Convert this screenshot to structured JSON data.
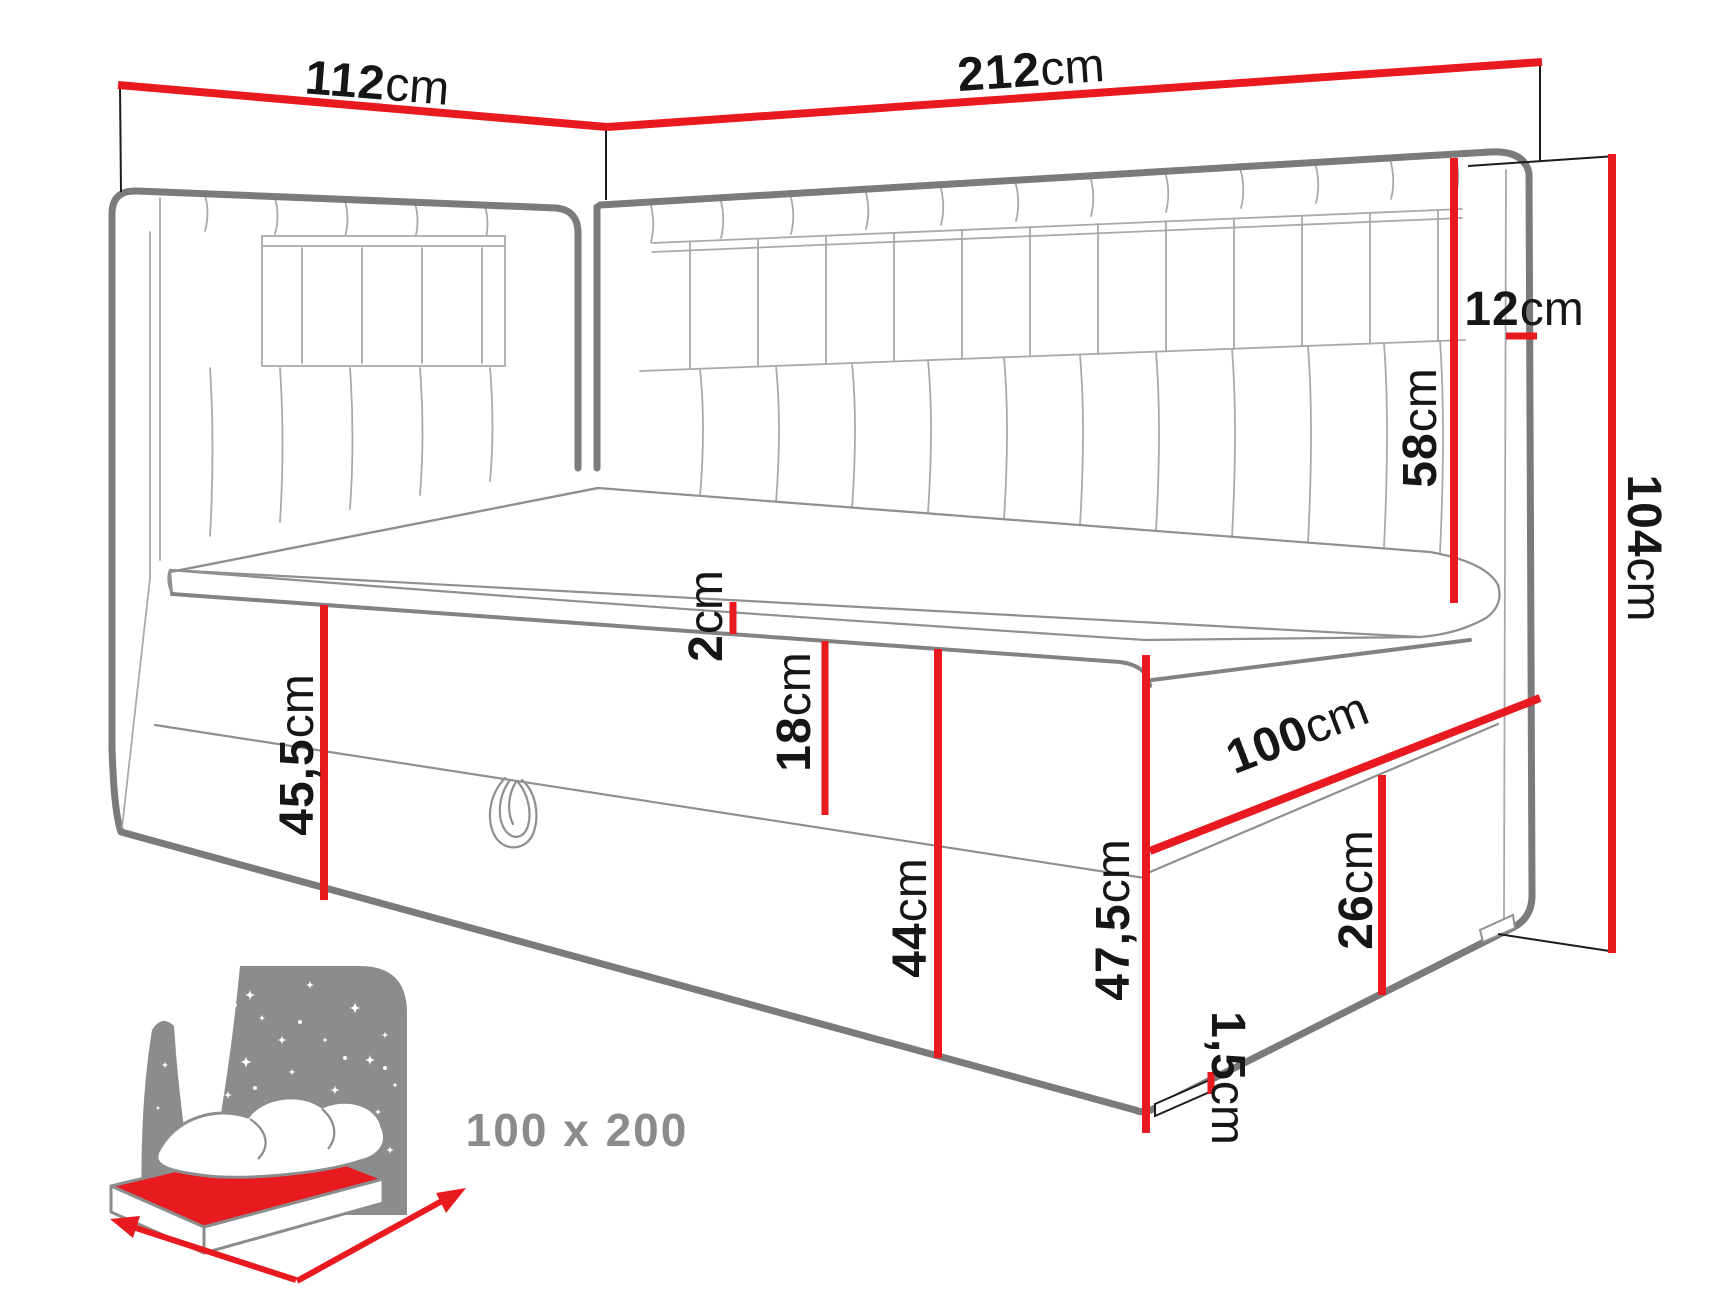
{
  "diagram": {
    "kind": "furniture-dimension-drawing",
    "subject": "corner daybed with two upholstered headboards and storage base",
    "colors": {
      "dimension_line": "#e8191f",
      "drawing_outline": "#7b7b7b",
      "label_text": "#161616",
      "icon_gray": "#8c8c8c"
    },
    "dimensions": {
      "side_headboard_width": {
        "value": "112",
        "unit": "cm"
      },
      "back_headboard_width": {
        "value": "212",
        "unit": "cm"
      },
      "headboard_thickness": {
        "value": "12",
        "unit": "cm"
      },
      "headboard_above_mattress": {
        "value": "58",
        "unit": "cm"
      },
      "total_height": {
        "value": "104",
        "unit": "cm"
      },
      "topper_thickness": {
        "value": "2",
        "unit": "cm"
      },
      "mattress_thickness": {
        "value": "18",
        "unit": "cm"
      },
      "base_height_side": {
        "value": "45,5",
        "unit": "cm"
      },
      "storage_depth": {
        "value": "44",
        "unit": "cm"
      },
      "front_corner_height": {
        "value": "47,5",
        "unit": "cm"
      },
      "bed_width": {
        "value": "100",
        "unit": "cm"
      },
      "foot_panel_height": {
        "value": "26",
        "unit": "cm"
      },
      "leg_height": {
        "value": "1,5",
        "unit": "cm"
      }
    },
    "size_badge": {
      "label": "100 x 200"
    }
  }
}
